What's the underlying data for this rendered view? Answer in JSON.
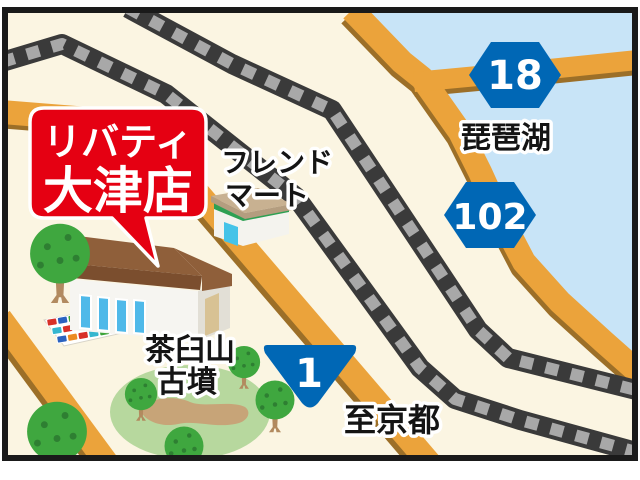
{
  "map": {
    "store_sign": {
      "line1": "リバティ",
      "line2": "大津店",
      "bg_color": "#E50012",
      "text_color": "#FFFFFF"
    },
    "labels": {
      "friend_mart": {
        "line1": "フレンド",
        "line2": "マート"
      },
      "lake": "琵琶湖",
      "kofun": {
        "line1": "茶臼山",
        "line2": "古墳"
      },
      "to_kyoto": "至京都"
    },
    "badges": {
      "route18": "18",
      "route102": "102",
      "route1": "1",
      "badge_color": "#0067B5"
    },
    "colors": {
      "background": "#FBF5E2",
      "lake": "#C8E4F7",
      "road": "#EBA33B",
      "road_shadow": "#9C6F28",
      "rail_dark": "#3A3A3A",
      "rail_light": "#A8A8A8",
      "frame": "#1A1A1A",
      "mound_green": "#B7D89E",
      "tree_green": "#3FA73F"
    }
  }
}
